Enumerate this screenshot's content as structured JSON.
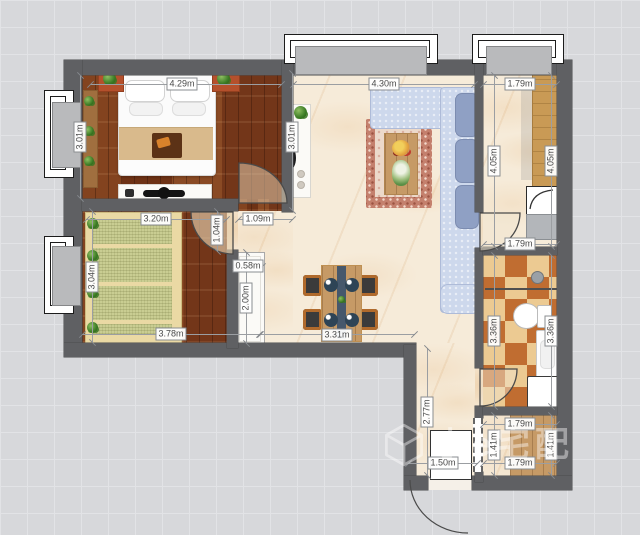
{
  "watermark": {
    "icon": "cube-logo-icon",
    "text": "小e宅配"
  },
  "dimensions": [
    {
      "id": "bedroom-top-width",
      "text": "4.29m"
    },
    {
      "id": "living-top-width",
      "text": "4.30m"
    },
    {
      "id": "kitchen-top-width",
      "text": "1.79m"
    },
    {
      "id": "bedroom-left-height",
      "text": "3.01m"
    },
    {
      "id": "living-left-height",
      "text": "3.01m"
    },
    {
      "id": "tatami-top-width",
      "text": "3.20m"
    },
    {
      "id": "hall-top-width",
      "text": "1.09m"
    },
    {
      "id": "tatami-door-height",
      "text": "1.04m"
    },
    {
      "id": "tatami-left-height",
      "text": "3.04m"
    },
    {
      "id": "hall-cabinet-width",
      "text": "0.58m"
    },
    {
      "id": "hall-cabinet-height",
      "text": "2.00m"
    },
    {
      "id": "tatami-bottom-width",
      "text": "3.78m"
    },
    {
      "id": "dining-bottom-width",
      "text": "3.31m"
    },
    {
      "id": "kitchen-inner-height",
      "text": "4.05m"
    },
    {
      "id": "kitchen-right-height",
      "text": "4.05m"
    },
    {
      "id": "hallway-width",
      "text": "1.79m"
    },
    {
      "id": "bath-left-height",
      "text": "3.36m"
    },
    {
      "id": "bath-right-height",
      "text": "3.36m"
    },
    {
      "id": "corridor-height",
      "text": "2.77m"
    },
    {
      "id": "entry-door-width",
      "text": "1.50m"
    },
    {
      "id": "entry-top-width",
      "text": "1.79m"
    },
    {
      "id": "entry-left-height",
      "text": "1.41m"
    },
    {
      "id": "entry-right-height",
      "text": "1.41m"
    },
    {
      "id": "entry-bottom-width",
      "text": "1.79m"
    }
  ],
  "colors": {
    "background": "#d7d8db",
    "wall": "#5f6063",
    "wood_dark_floor": "#7a3b1c",
    "wood_light_floor": "#c69a66",
    "marble_floor": "#f6ebd9",
    "tatami_mat": "#c9cd92",
    "bath_tile_rust": "#c06d31",
    "bath_tile_tan": "#ecca92",
    "sofa_blue": "#cdd8ec",
    "window_slab_gray": "#b9babc"
  }
}
